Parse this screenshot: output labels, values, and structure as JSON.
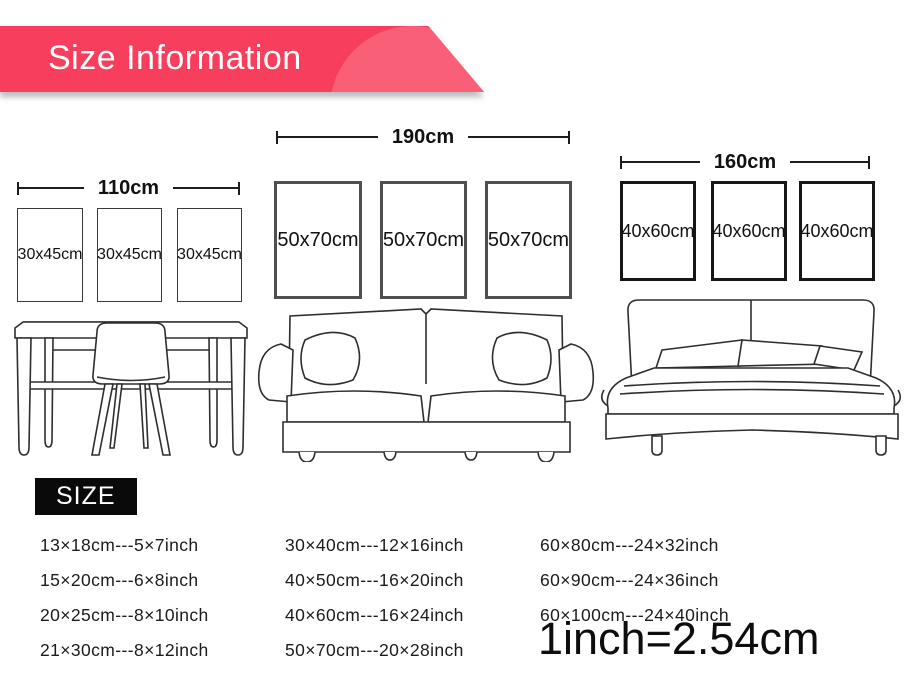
{
  "banner": {
    "title": "Size Information"
  },
  "colors": {
    "banner": "#f83e5d",
    "banner_blob": "#fa5f78"
  },
  "groups": [
    {
      "name": "desk",
      "width_label": "110cm",
      "frames": [
        "30x45cm",
        "30x45cm",
        "30x45cm"
      ]
    },
    {
      "name": "sofa",
      "width_label": "190cm",
      "frames": [
        "50x70cm",
        "50x70cm",
        "50x70cm"
      ]
    },
    {
      "name": "bed",
      "width_label": "160cm",
      "frames": [
        "40x60cm",
        "40x60cm",
        "40x60cm"
      ]
    }
  ],
  "size_heading": "SIZE",
  "conversion_table": {
    "columns": [
      {
        "rows": [
          "13×18cm---5×7inch",
          "15×20cm---6×8inch",
          "20×25cm---8×10inch",
          "21×30cm---8×12inch"
        ]
      },
      {
        "rows": [
          "30×40cm---12×16inch",
          "40×50cm---16×20inch",
          "40×60cm---16×24inch",
          "50×70cm---20×28inch"
        ]
      },
      {
        "rows": [
          "60×80cm---24×32inch",
          "60×90cm---24×36inch",
          "60×100cm---24×40inch"
        ]
      }
    ],
    "note": "1inch=2.54cm"
  }
}
